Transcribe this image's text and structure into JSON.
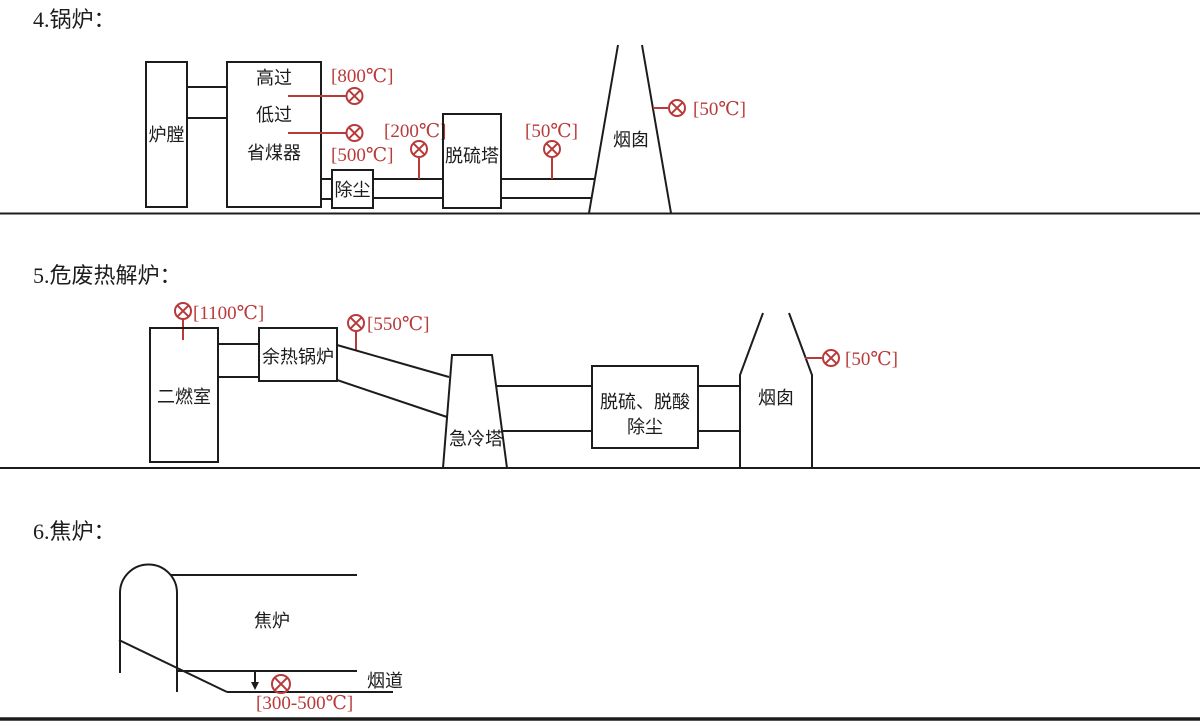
{
  "colors": {
    "accent_red": "#b93a3a",
    "line_black": "#1c1c1c",
    "background": "#ffffff"
  },
  "sections": [
    {
      "title": "4.锅炉：",
      "labels": {
        "furnace_chamber": "炉膛",
        "high_superheater": "高过",
        "low_superheater": "低过",
        "economizer": "省煤器",
        "dust_removal": "除尘",
        "desulfurization_tower": "脱硫塔",
        "chimney": "烟囱"
      },
      "sensors": {
        "after_high_superheater": "[800℃]",
        "after_economizer": "[500℃]",
        "after_dust_removal": "[200℃]",
        "after_desulfurization": "[50℃]",
        "chimney_outlet": "[50℃]"
      }
    },
    {
      "title": "5.危废热解炉：",
      "labels": {
        "secondary_combustion_chamber": "二燃室",
        "waste_heat_boiler": "余热锅炉",
        "quench_tower": "急冷塔",
        "treatment_line1": "脱硫、脱酸",
        "treatment_line2": "除尘",
        "chimney": "烟囱"
      },
      "sensors": {
        "secondary_combustion_outlet": "[1100℃]",
        "waste_heat_boiler_outlet": "[550℃]",
        "chimney_outlet": "[50℃]"
      }
    },
    {
      "title": "6.焦炉：",
      "labels": {
        "coke_oven": "焦炉",
        "flue": "烟道"
      },
      "sensors": {
        "flue_temperature": "[300-500℃]"
      }
    }
  ]
}
